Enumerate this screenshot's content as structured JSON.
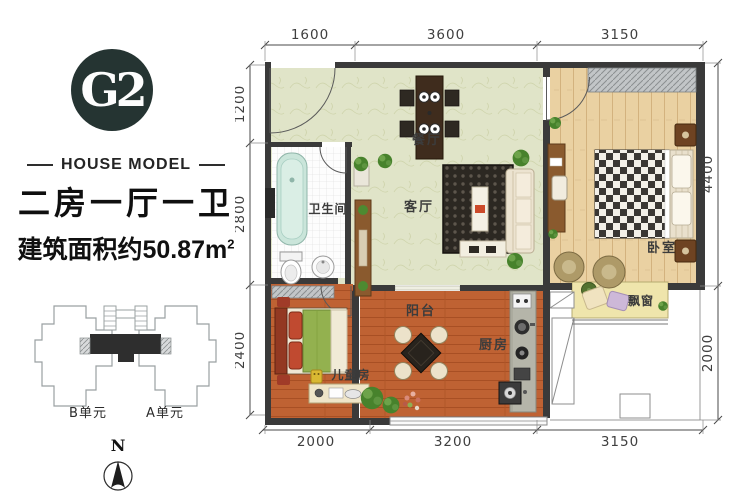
{
  "sidebar": {
    "logo_text": "G2",
    "subtitle": "HOUSE MODEL",
    "title": "二房一厅一卫",
    "area_text": "建筑面积约50.87m",
    "area_sup": "2",
    "unit_b": "B单元",
    "unit_a": "A单元",
    "north_label": "N"
  },
  "plan": {
    "rooms": {
      "dining": "餐厅",
      "bathroom": "卫生间",
      "living": "客厅",
      "bedroom": "卧室",
      "balcony": "阳台",
      "kitchen": "厨房",
      "kids": "儿童房",
      "bay": "飘窗"
    },
    "dims": {
      "top": [
        "1600",
        "3600",
        "3150"
      ],
      "bottom": [
        "2000",
        "3200",
        "3150"
      ],
      "left": [
        "1200",
        "2800",
        "2400"
      ],
      "right": [
        "4400",
        "2000"
      ]
    }
  },
  "colors": {
    "wall": "#3a3a3a",
    "logo_bg": "#253432",
    "floor_main": "#e0e4c8",
    "floor_wood": "#ead1a2",
    "floor_terracotta": "#bf6233",
    "bay_window": "#efe5ac",
    "bathtub": "#cae5da"
  }
}
